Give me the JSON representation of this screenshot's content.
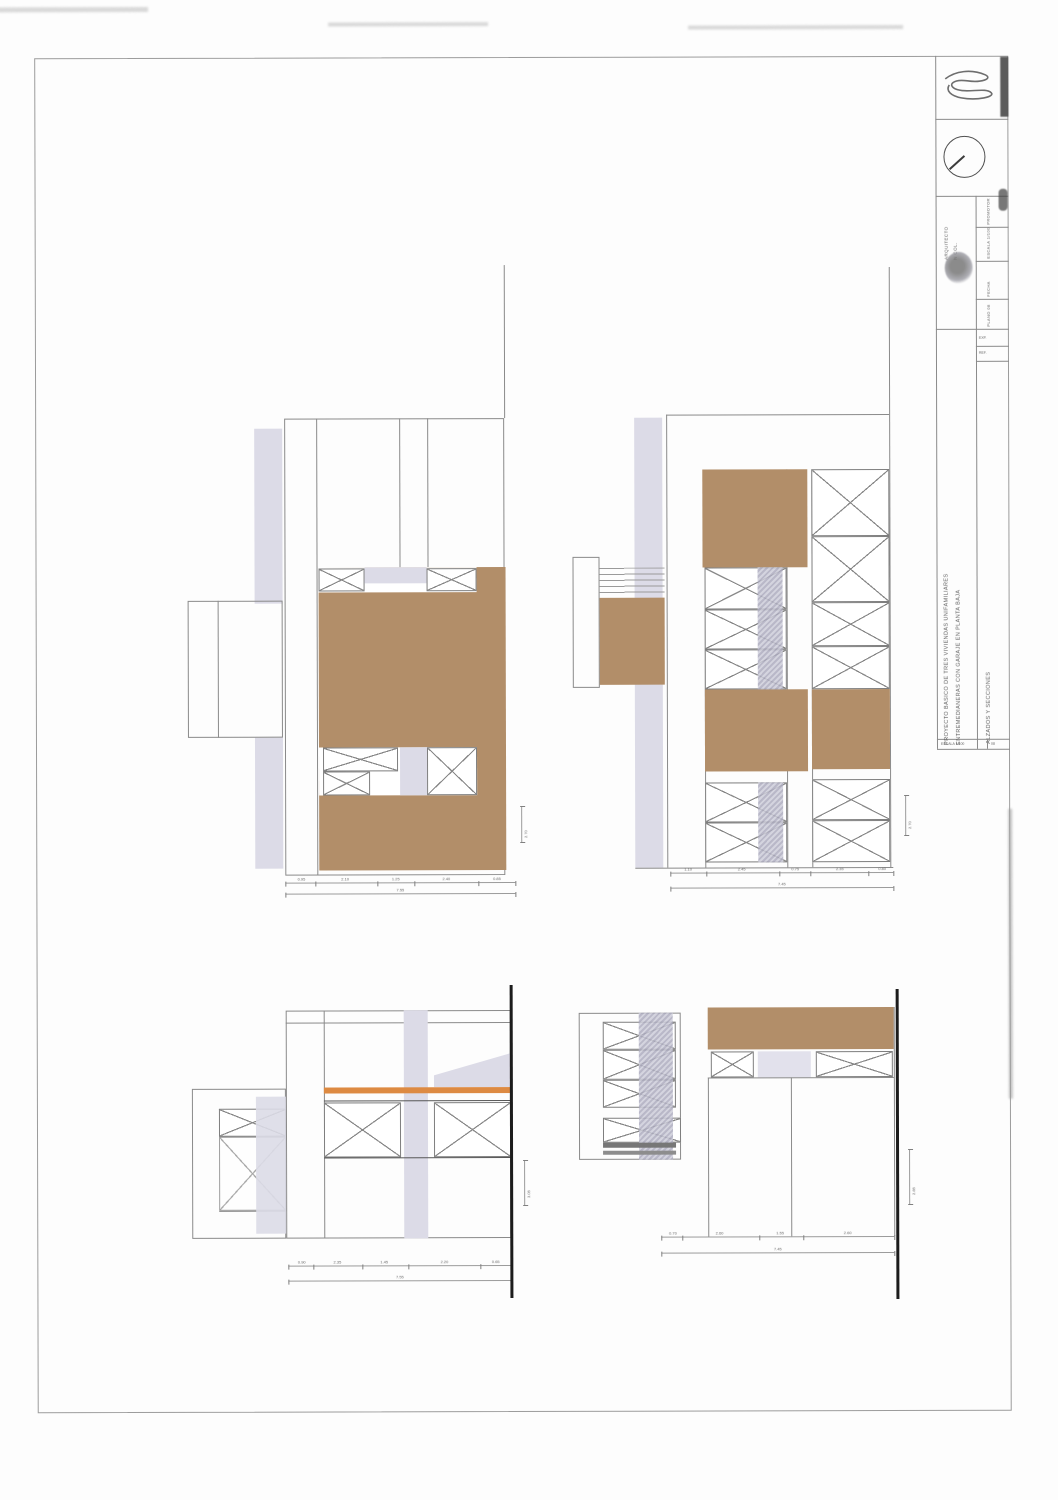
{
  "document": {
    "kind": "scanned architectural drawing sheet",
    "views": [
      "elevation-top-left",
      "elevation-top-right",
      "section-bottom-left",
      "section-bottom-right"
    ]
  },
  "colors": {
    "facade_brown": "#b28e69",
    "wall_lavender": "#dcdbe7",
    "floor_orange": "#dd8a42",
    "hatch_gray": "#adacbf",
    "ink": "#8a8a8a",
    "cut_black": "#1c1c1c"
  },
  "title_block": {
    "project_title_line1": "PROYECTO BASICO DE TRES VIVIENDAS UNIFAMILIARES",
    "project_title_line2": "ENTREMEDIANERAS CON GARAJE EN PLANTA BAJA",
    "drawing_title": "ALZADOS Y SECCIONES",
    "architect_line1": "ARQUITECTO",
    "architect_line2": "N COL.",
    "meta_cells": [
      "PROMOTOR",
      "ESCALA 1/100",
      "FECHA",
      "PLANO 08"
    ],
    "top_rows": [
      "EXP.",
      "REF."
    ],
    "footer_left": "ESCALA 1/100",
    "footer_right": "08"
  },
  "dims": {
    "top_left": {
      "row1": [
        "0.95",
        "2.10",
        "1.25",
        "2.40",
        "0.85"
      ],
      "row2": "7.55",
      "side": "2.70"
    },
    "top_right": {
      "row1": [
        "1.10",
        "2.45",
        "0.75",
        "2.35",
        "0.80"
      ],
      "row2": "7.45",
      "side": "2.70"
    },
    "bottom_left": {
      "row1": [
        "0.90",
        "2.35",
        "1.45",
        "2.20",
        "0.65"
      ],
      "row2": "7.55",
      "side": "3.05"
    },
    "bottom_right": {
      "row1": [
        "0.70",
        "2.60",
        "1.55",
        "2.60"
      ],
      "row2": "7.45",
      "side": "2.85"
    }
  }
}
